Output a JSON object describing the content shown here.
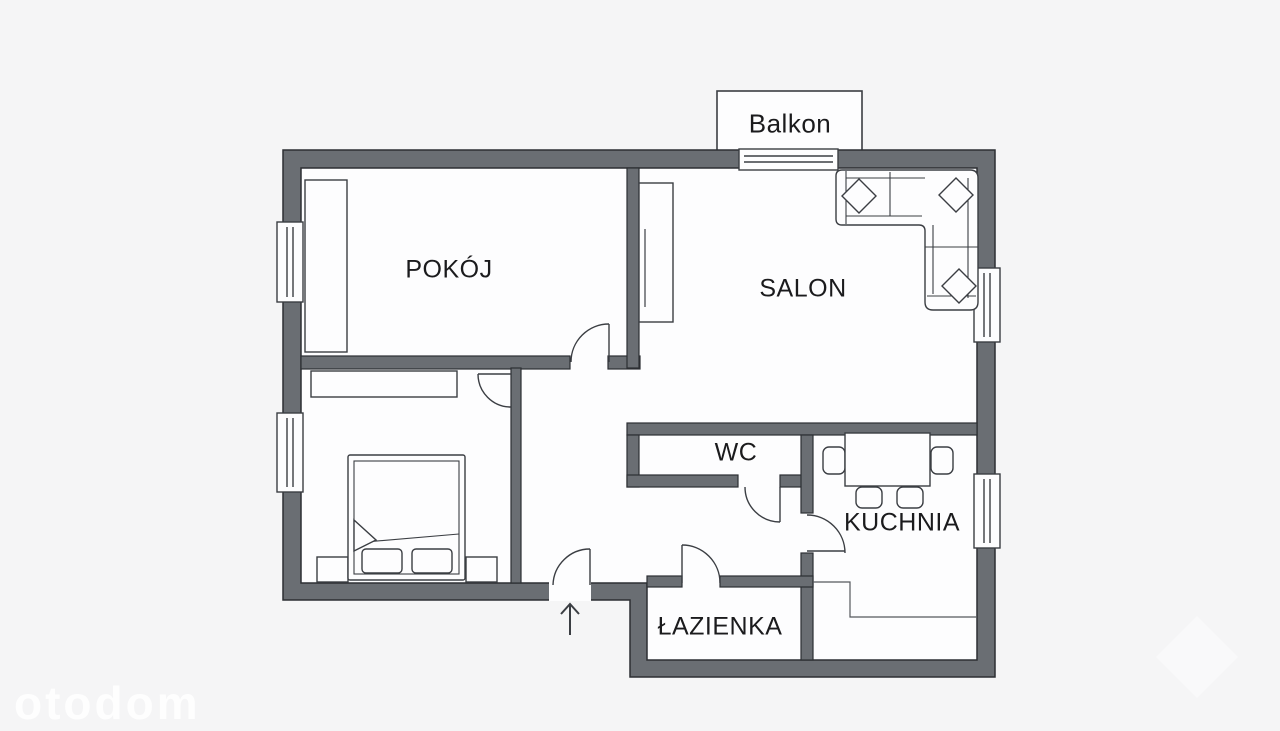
{
  "plan": {
    "rooms": {
      "balkon": "Balkon",
      "pokoj": "POKÓJ",
      "salon": "SALON",
      "wc": "WC",
      "kuchnia": "KUCHNIA",
      "lazienka": "ŁAZIENKA"
    },
    "watermark": "otodom",
    "entrance_marker": "up-arrow",
    "colors": {
      "bg": "#f5f5f6",
      "floor": "#fdfdfe",
      "wall": "#6a6e73",
      "wall-edge": "#2c2f33",
      "line": "#3b3e43",
      "thin": "#55585d",
      "text": "#1b1b1d",
      "watermark": "#ffffff"
    }
  }
}
